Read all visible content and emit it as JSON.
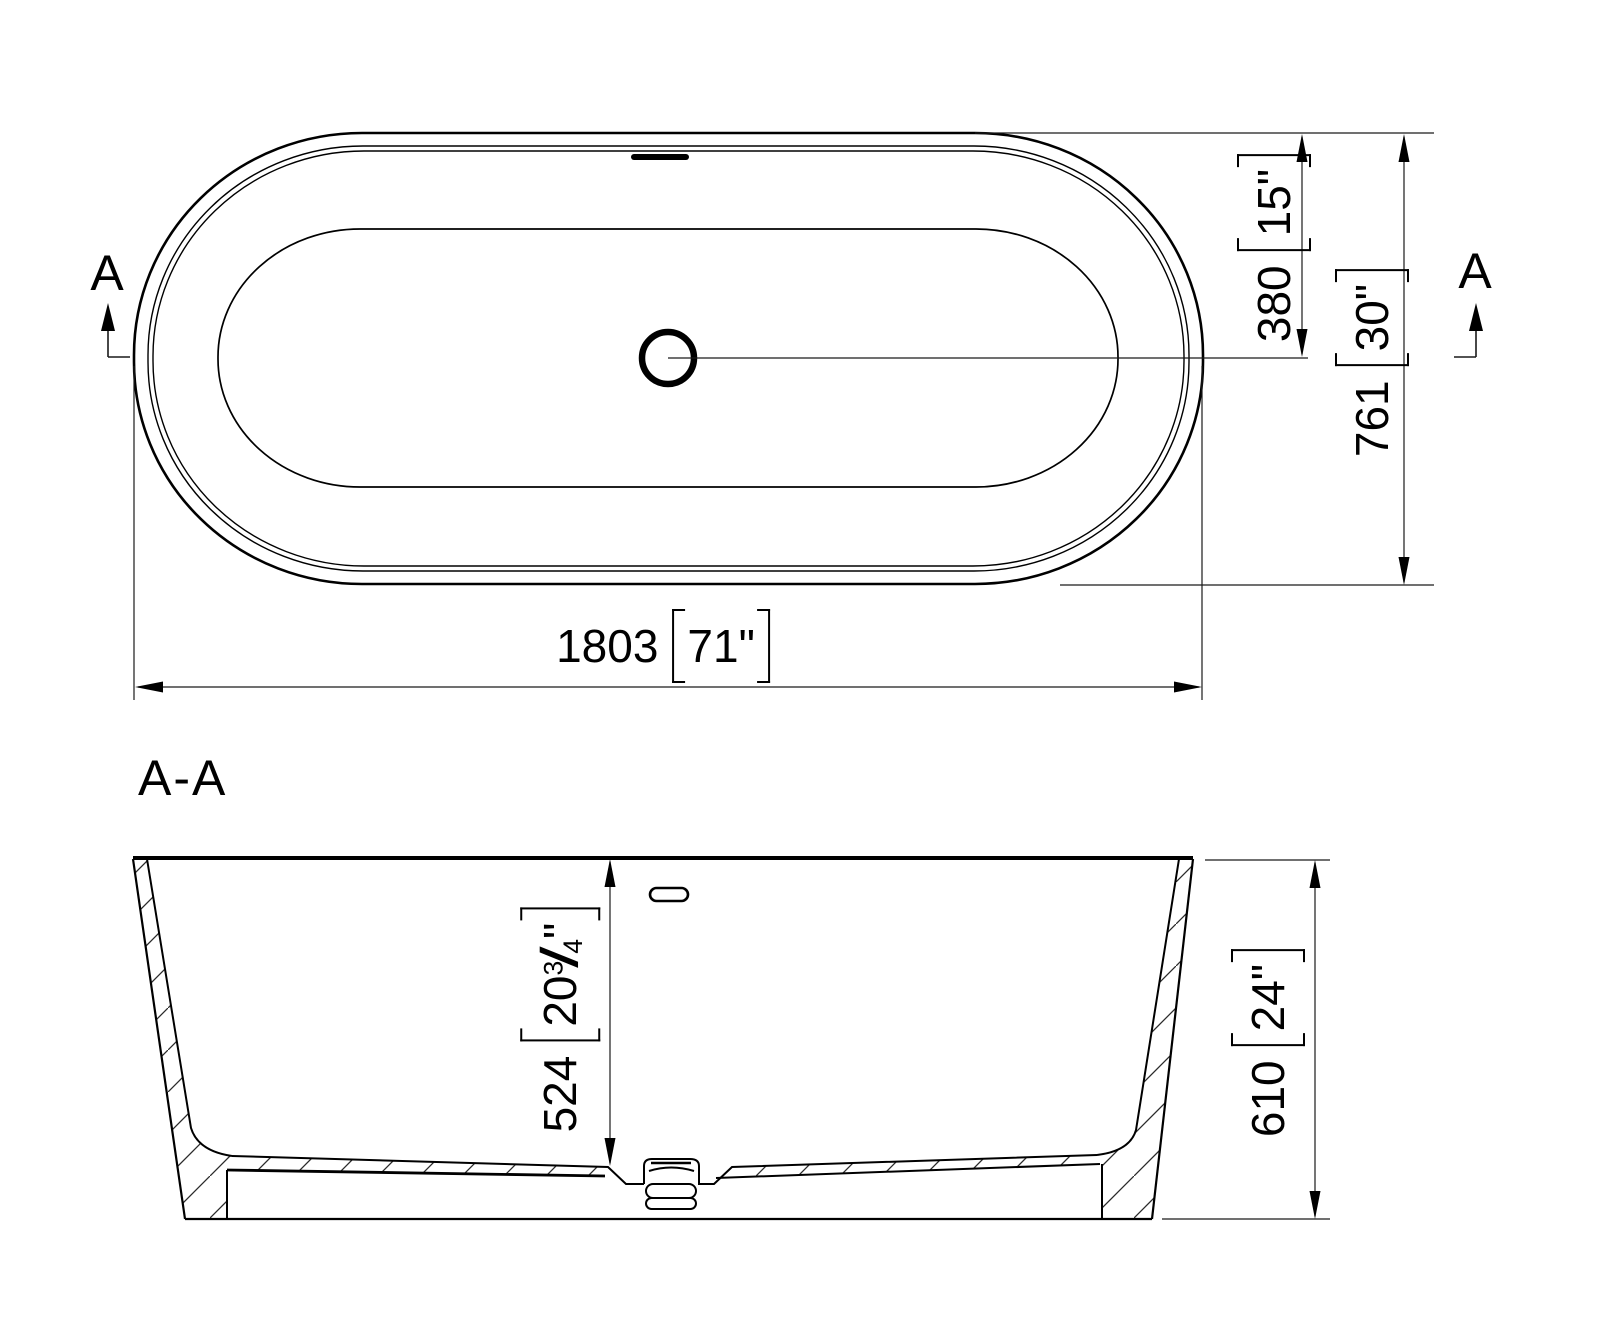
{
  "top_view": {
    "marker_left": "A",
    "marker_right": "A",
    "dim_drain_to_edge": {
      "mm": "380",
      "inch": "15\""
    },
    "dim_overall_width": {
      "mm": "761",
      "inch": "30\""
    },
    "dim_overall_length": {
      "mm": "1803",
      "inch": "71\""
    }
  },
  "section_view": {
    "label": "A-A",
    "dim_inner_depth": {
      "mm": "524",
      "inch_whole": "20",
      "inch_frac_num": "3",
      "inch_frac_den": "4",
      "inch_mark": "\""
    },
    "dim_overall_height": {
      "mm": "610",
      "inch": "24\""
    }
  },
  "colors": {
    "line": "#000000",
    "dim_line": "#1a1a1a",
    "background": "#ffffff"
  }
}
